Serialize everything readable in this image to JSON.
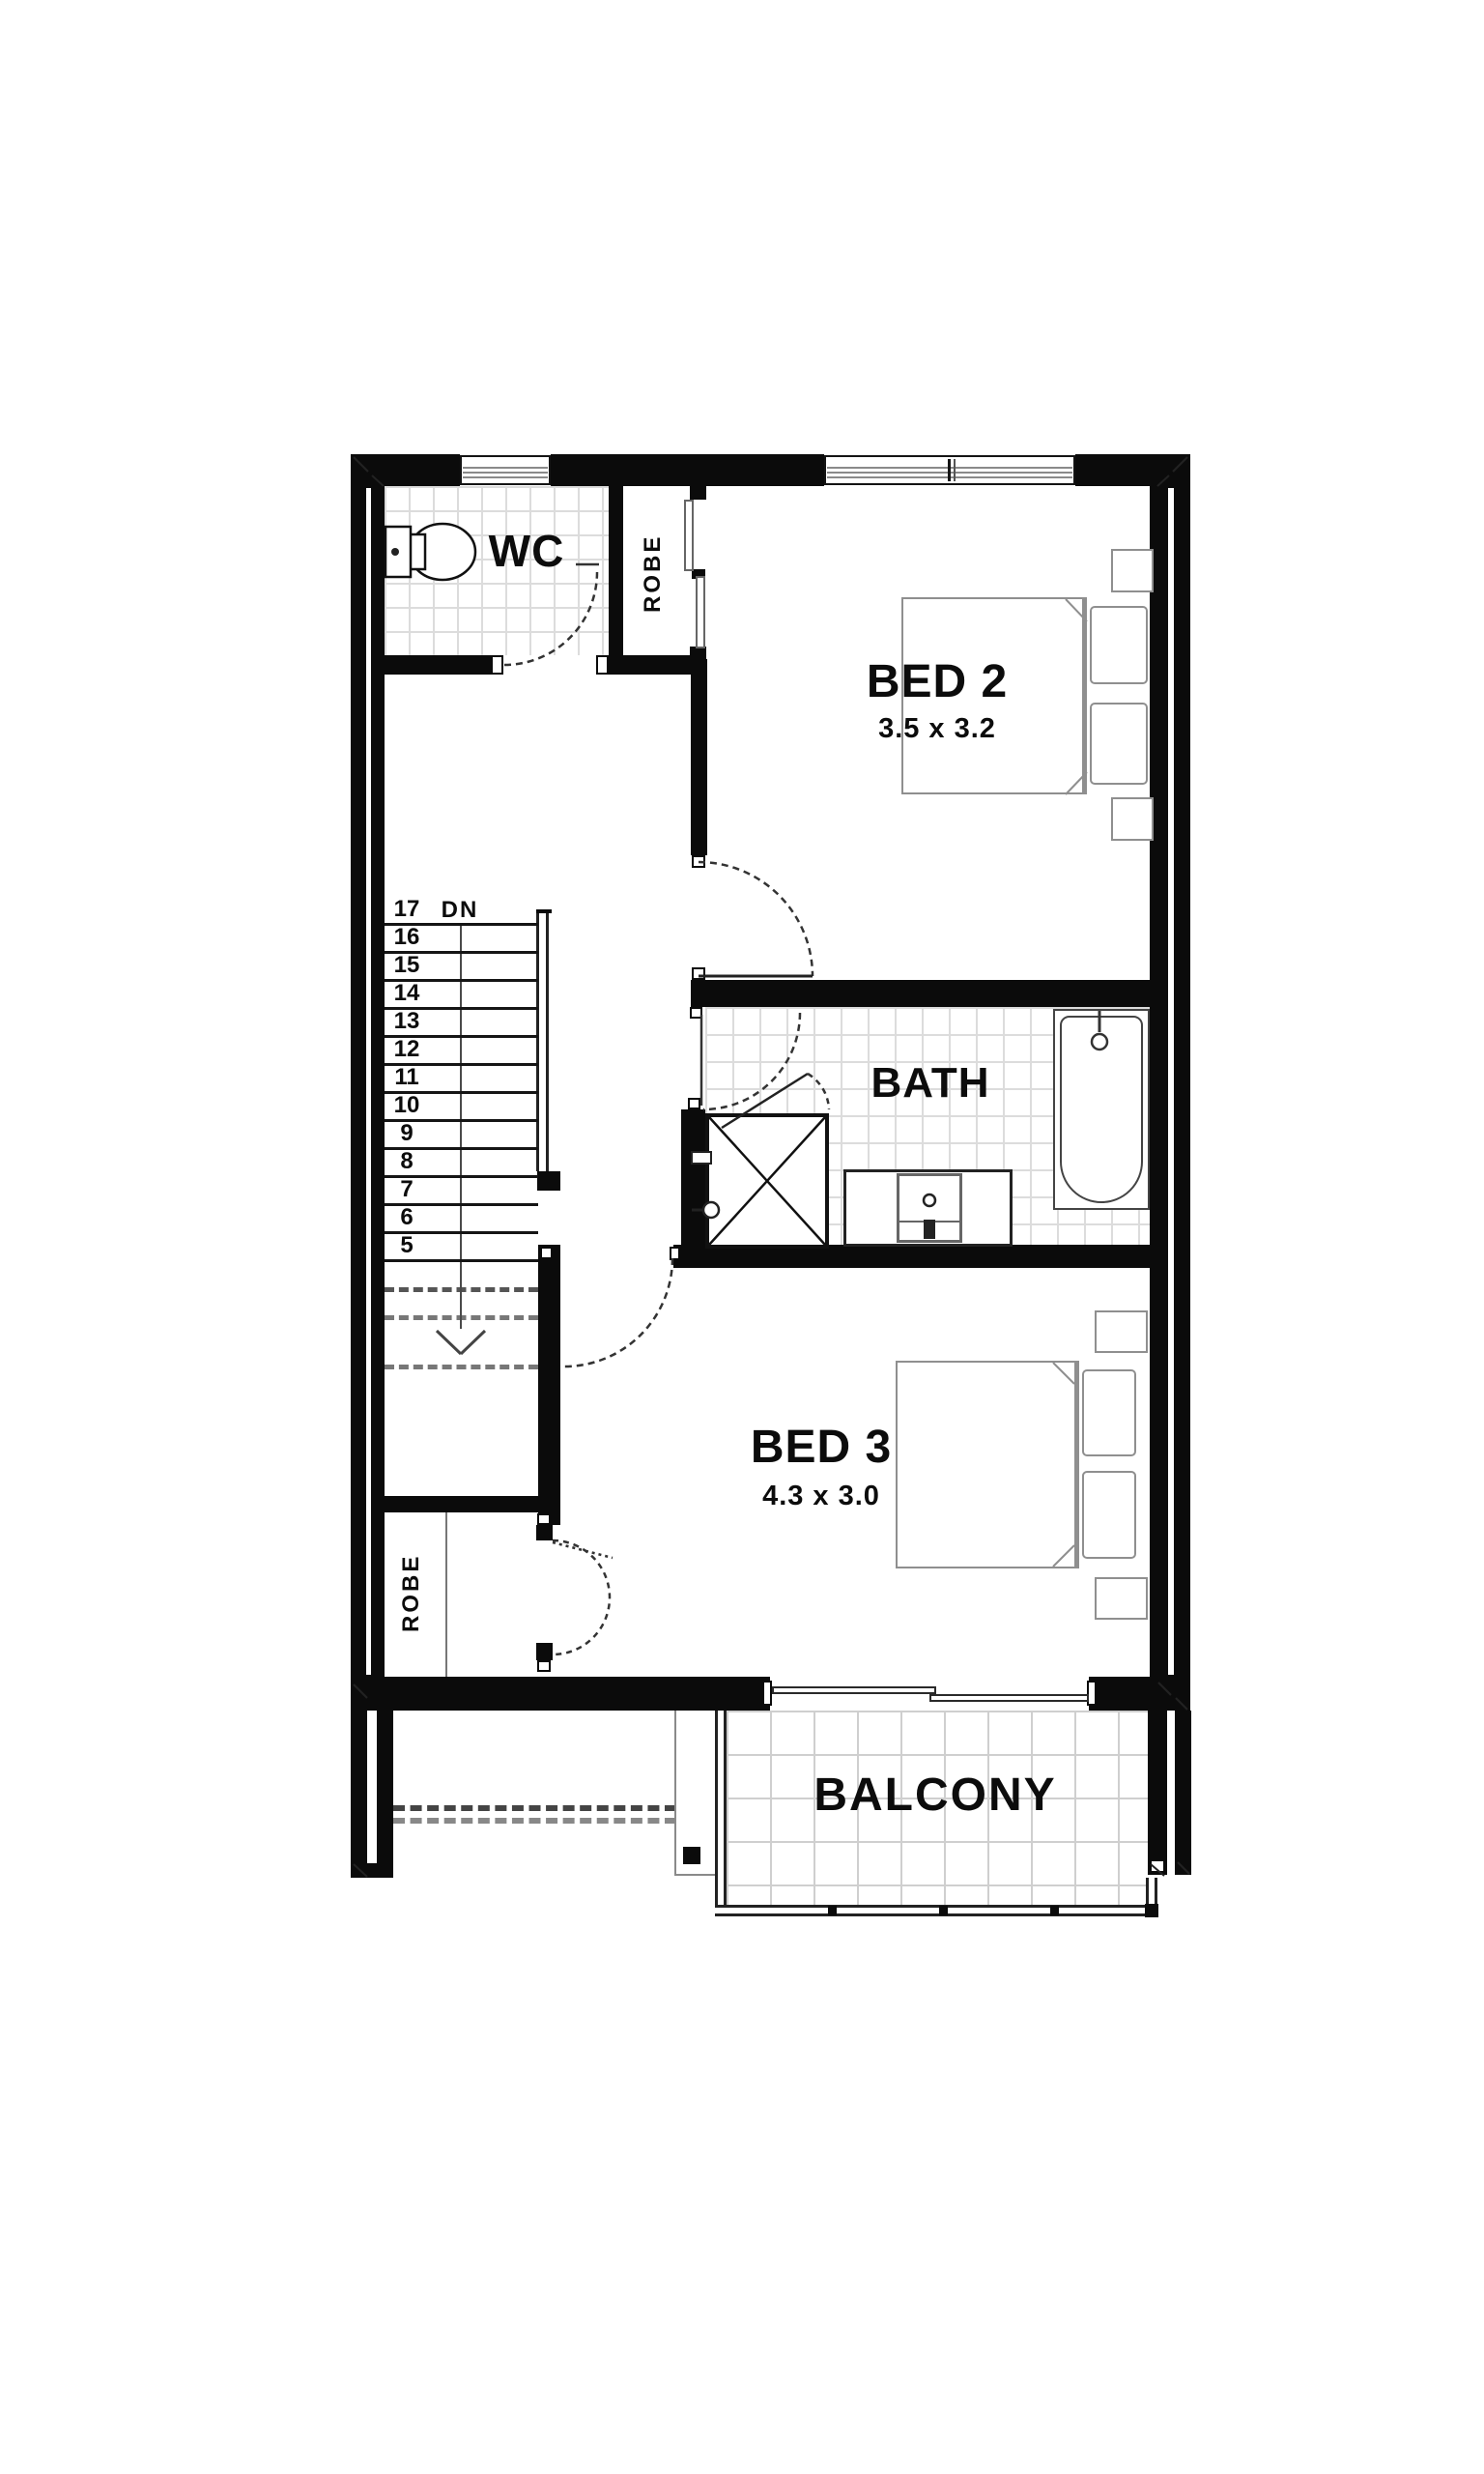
{
  "plan_title": "Upper floor plan",
  "palette": {
    "wall": "#0b0b0b",
    "furniture_line": "#8f8f8f",
    "tile_line": "#dcdcdc",
    "fixture_line": "#333333"
  },
  "rooms": {
    "wc": {
      "label": "WC"
    },
    "robe_upper": {
      "label": "ROBE"
    },
    "bed2": {
      "label": "BED 2",
      "dims": "3.5 x 3.2"
    },
    "bath": {
      "label": "BATH"
    },
    "bed3": {
      "label": "BED 3",
      "dims": "4.3 x 3.0"
    },
    "robe_lower": {
      "label": "ROBE"
    },
    "balcony": {
      "label": "BALCONY"
    }
  },
  "stairs": {
    "dn_label": "DN",
    "treads": [
      "17",
      "16",
      "15",
      "14",
      "13",
      "12",
      "11",
      "10",
      "9",
      "8",
      "7",
      "6",
      "5"
    ]
  }
}
